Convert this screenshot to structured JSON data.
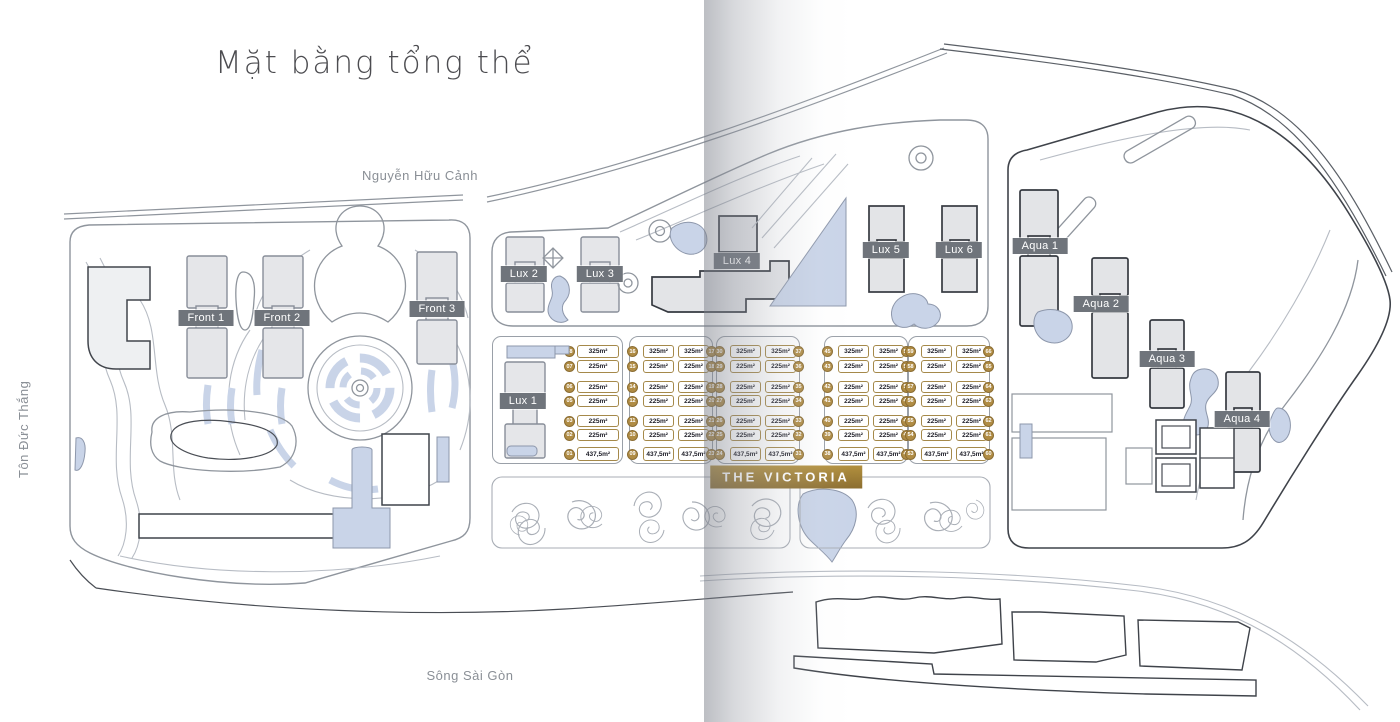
{
  "title": "Mặt bằng tổng thể",
  "streets": {
    "top": "Nguyễn Hữu Cảnh",
    "left": "Tôn Đức Thắng",
    "river": "Sông Sài Gòn"
  },
  "badges": {
    "victoria": "THE VICTORIA",
    "front": [
      "Front 1",
      "Front 2",
      "Front 3"
    ],
    "lux": [
      "Lux 1",
      "Lux 2",
      "Lux 3",
      "Lux 4",
      "Lux 5",
      "Lux 6"
    ],
    "aqua": [
      "Aqua 1",
      "Aqua 2",
      "Aqua 3",
      "Aqua 4"
    ]
  },
  "villas": {
    "areas_by_row": [
      "325m²",
      "225m²",
      "225m²",
      "225m²",
      "225m²",
      "225m²",
      "437,5m²"
    ],
    "blocks": [
      {
        "columns": [
          {
            "side": "left",
            "numbers": [
              "08",
              "07",
              "06",
              "05",
              "03",
              "02",
              "01"
            ]
          }
        ]
      },
      {
        "columns": [
          {
            "side": "left",
            "numbers": [
              "16",
              "15",
              "14",
              "12",
              "11",
              "10",
              "09"
            ]
          },
          {
            "side": "right",
            "numbers": [
              "17",
              "18",
              "19",
              "20",
              "21",
              "22",
              "23"
            ]
          }
        ]
      },
      {
        "columns": [
          {
            "side": "left",
            "numbers": [
              "30",
              "29",
              "28",
              "27",
              "26",
              "25",
              "24"
            ]
          },
          {
            "side": "right",
            "numbers": [
              "37",
              "36",
              "35",
              "34",
              "33",
              "32",
              "31"
            ]
          }
        ]
      },
      {
        "columns": [
          {
            "side": "left",
            "numbers": [
              "45",
              "43",
              "42",
              "41",
              "40",
              "39",
              "38"
            ]
          },
          {
            "side": "right",
            "numbers": [
              "52",
              "51",
              "50",
              "49",
              "48",
              "47",
              "46"
            ]
          }
        ]
      },
      {
        "columns": [
          {
            "side": "left",
            "numbers": [
              "59",
              "58",
              "57",
              "56",
              "55",
              "54",
              "53"
            ]
          },
          {
            "side": "right",
            "numbers": [
              "66",
              "65",
              "64",
              "63",
              "62",
              "61",
              "60"
            ]
          }
        ]
      }
    ]
  },
  "colors": {
    "gold_accent": "#ab8b46",
    "badge_gray": "#6f747b",
    "water_blue": "#c9d4e8",
    "line_gray": "#8f959d",
    "dark_line": "#3f434a",
    "building_fill": "#e5e6e9"
  }
}
